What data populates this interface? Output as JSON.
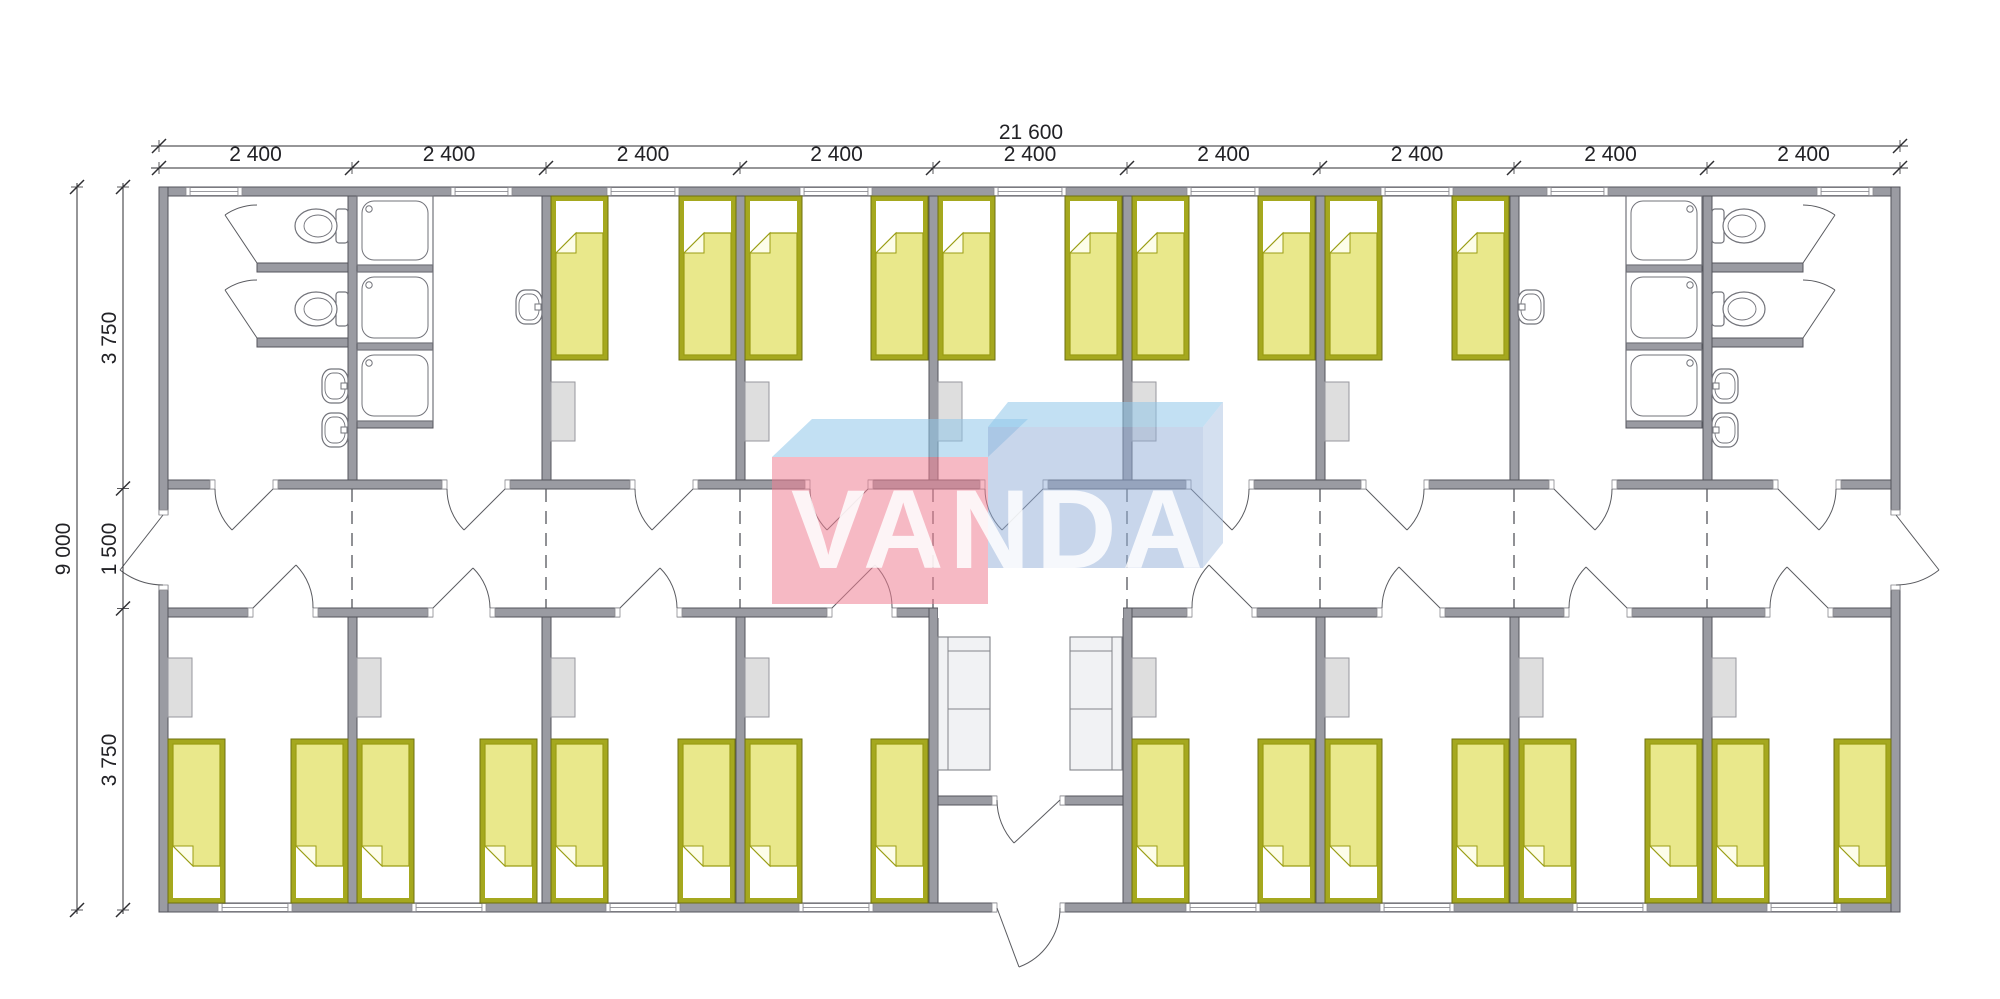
{
  "watermark": {
    "text": "VANDA"
  },
  "dimensions": {
    "overall_width": "21 600",
    "modules": [
      "2 400",
      "2 400",
      "2 400",
      "2 400",
      "2 400",
      "2 400",
      "2 400",
      "2 400",
      "2 400"
    ],
    "overall_height": "9 000",
    "height_segments": [
      "3 750",
      "1 500",
      "3 750"
    ]
  },
  "colors": {
    "wall_fill": "#9a9ba2",
    "wall_stroke": "#54555c",
    "bed_frame": "#a5a81e",
    "bed_frame_stroke": "#6e7110",
    "bed_blanket": "#e9e88b",
    "bed_blanket_stroke": "#9a9d14",
    "furniture_fill": "#dedede",
    "furniture_stroke": "#97979d",
    "fixture_stroke": "#72737a",
    "sofa_fill": "#f1f2f4",
    "dimension_color": "#2e2e32",
    "logo_pink": "#ee7f94",
    "logo_blue_top": "#8fc6ea",
    "logo_blue_face": "#92aed8",
    "logo_blue_side": "#a9c2e2",
    "logo_letter": "#ffffff"
  },
  "inventory": {
    "bedrooms": 13,
    "beds": 26,
    "wardrobes": 13,
    "wc_rooms": 2,
    "toilet_stalls": 4,
    "toilets": 4,
    "showers": 6,
    "wash_basins": 6,
    "washrooms": 2,
    "corridor": 1,
    "entrance_lobby": 1,
    "sofas": 2,
    "windows": 17
  }
}
